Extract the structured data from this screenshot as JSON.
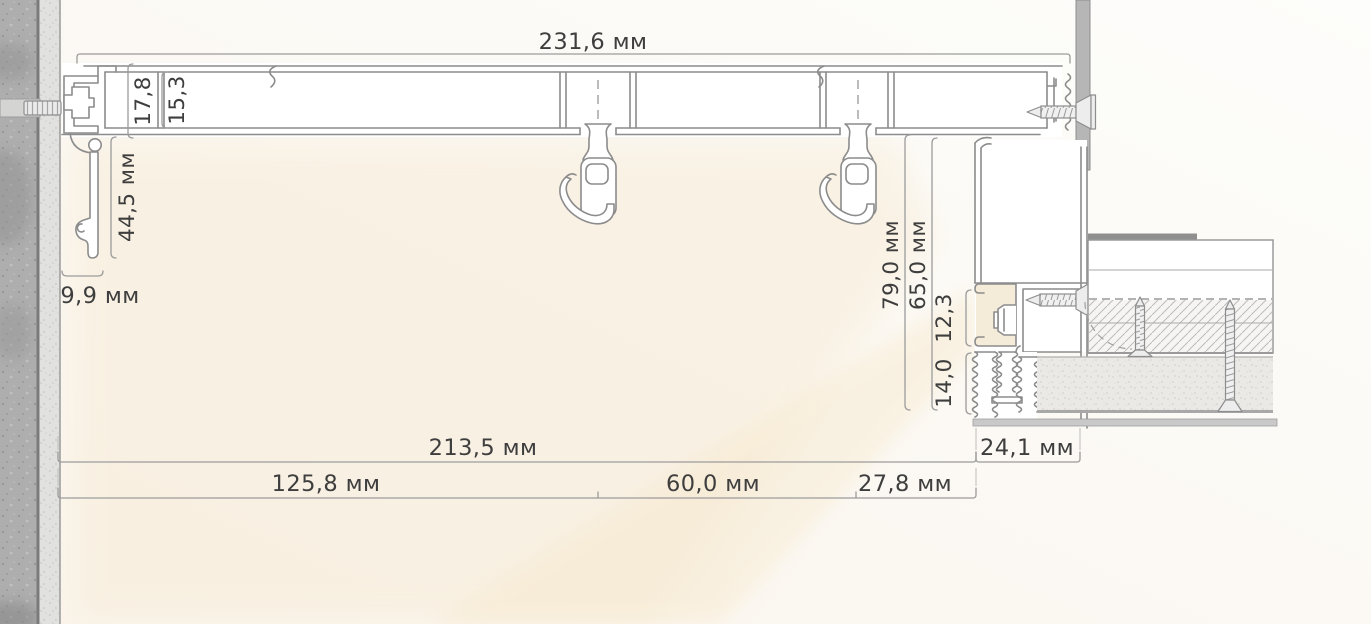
{
  "drawing": {
    "title_context": "curtain-track-ceiling-niche-section",
    "unit": "мм",
    "dims": {
      "track_total_width": "231,6 мм",
      "track_height_outer": "17,8",
      "track_height_inner": "15,3",
      "wall_trim_drop": "44,5 мм",
      "wall_trim_width": "9,9 мм",
      "right_drop_outer": "79,0 мм",
      "right_drop_inner": "65,0 мм",
      "led_niche_height": "12,3",
      "lower_trim_height": "14,0",
      "bottom_span_total": "213,5 мм",
      "soffit_width": "24,1 мм",
      "span_left": "125,8 мм",
      "span_mid": "60,0 мм",
      "span_right": "27,8 мм"
    },
    "colors": {
      "profile_line": "#8c8c8c",
      "dimension_line": "#9c9c9c",
      "wall_concrete": "#aeaeae",
      "warm_glow": "#f6ead6",
      "led_niche_fill": "#f5ebd9"
    }
  }
}
